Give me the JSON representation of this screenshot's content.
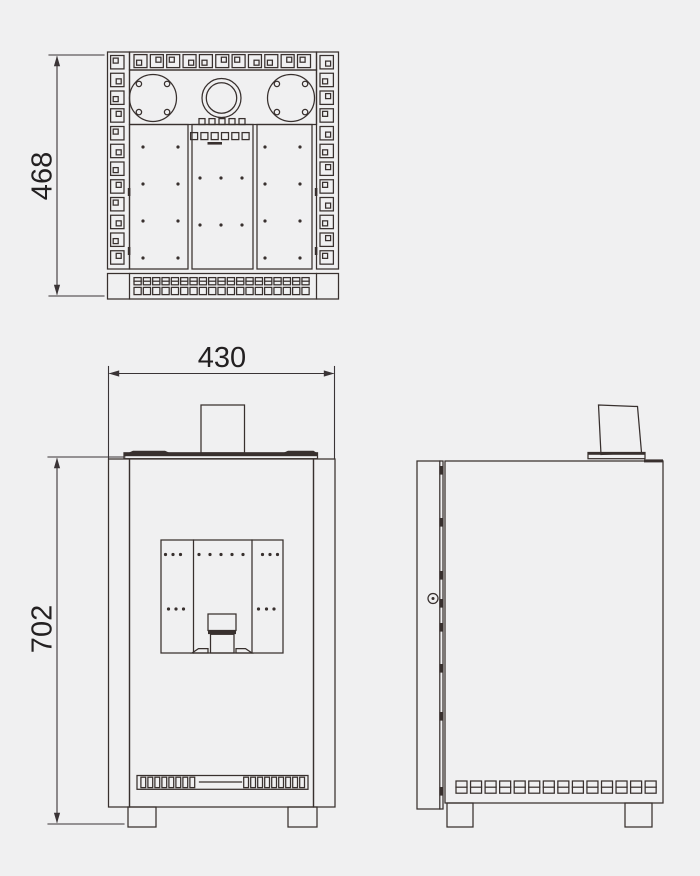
{
  "meta": {
    "title": "Stove three-view technical dimension drawing"
  },
  "colors": {
    "background": "#f0f0f1",
    "line": "#38302e",
    "dimension_line": "#3a3436",
    "text": "#232021"
  },
  "dim_labels": {
    "depth": "468",
    "width": "430",
    "height": "702"
  },
  "top_view": {
    "side_column_squares": 12,
    "top_strip_squares": 11,
    "base_row_squares": 19,
    "center_squares_row1": 5,
    "center_squares_row2": 6,
    "burner_bolts_per_circle": 4,
    "panel_dots": {
      "left_cols": [
        143,
        178
      ],
      "left_rows": [
        147,
        184,
        221,
        258
      ],
      "center_cols": [
        200,
        221,
        242
      ],
      "center_rows": [
        178,
        225
      ],
      "right_cols": [
        265,
        300
      ],
      "right_rows": [
        147,
        184,
        221,
        258
      ]
    }
  },
  "front_view": {
    "louver_slats_left": 8,
    "louver_slats_right": 9,
    "panel_dots": {
      "row_top_y": 554.5,
      "row_mid_y": 609,
      "top_groups": [
        [
          165.5,
          173,
          180.5
        ],
        [
          199,
          210,
          221,
          232,
          243
        ],
        [
          262.5,
          270,
          277.5
        ]
      ],
      "mid_groups": [
        [
          168.5,
          176,
          183.5
        ],
        [
          258.5,
          266.5,
          274
        ]
      ]
    }
  },
  "side_view": {
    "vent_squares": 14,
    "hinge_marks_y": [
      466,
      518,
      571,
      599,
      623,
      664,
      712,
      787
    ]
  }
}
